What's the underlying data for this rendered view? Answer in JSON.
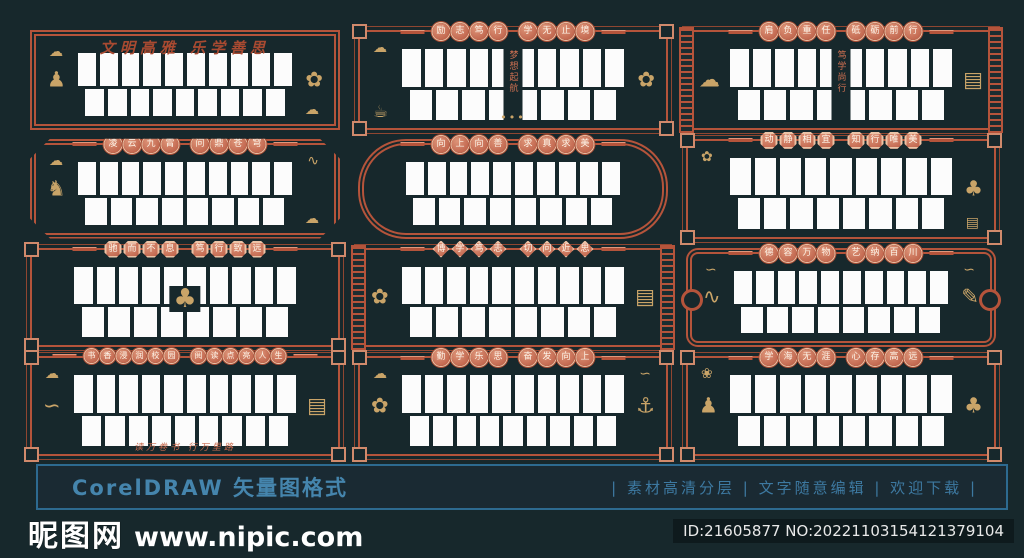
{
  "colors": {
    "background": "#17282c",
    "border_red": "#b5543b",
    "medallion_light": "#dd9478",
    "ornament_gold": "#c9a468",
    "bar_border_blue": "#2d6a90",
    "bar_text_blue": "#4585ad",
    "photo_white": "#fcfcfc"
  },
  "panels": [
    {
      "title": "文明高雅 乐学善思",
      "title_style": "calligraphy",
      "variant": "double",
      "photos_top": 10,
      "photos_bottom": 9,
      "ornaments": [
        {
          "icon": "cloud",
          "pos": "tl"
        },
        {
          "icon": "dancer",
          "pos": "l"
        },
        {
          "icon": "flower-vase",
          "pos": "r"
        },
        {
          "icon": "cloud",
          "pos": "br"
        }
      ]
    },
    {
      "title": "励志笃行 学无止境",
      "title_style": "circles",
      "variant": "corners",
      "photos_top": 10,
      "photos_bottom": 8,
      "center_text": "梦想起航",
      "ornaments": [
        {
          "icon": "cloud",
          "pos": "tl"
        },
        {
          "icon": "teapot",
          "pos": "bl"
        },
        {
          "icon": "flower-vase",
          "pos": "r"
        },
        {
          "icon": "water-drops",
          "pos": "cb"
        }
      ]
    },
    {
      "title": "肩负重任 砥砺前行",
      "title_style": "circles",
      "variant": "keys",
      "photos_top": 10,
      "photos_bottom": 8,
      "center_text": "笃学尚行",
      "ornaments": [
        {
          "icon": "cloud",
          "pos": "l"
        },
        {
          "icon": "scroll-stack",
          "pos": "r"
        }
      ]
    },
    {
      "title": "凌云九霄 问鼎苍穹",
      "title_style": "circles",
      "variant": "octagon",
      "photos_top": 10,
      "photos_bottom": 8,
      "ornaments": [
        {
          "icon": "cloud",
          "pos": "tl"
        },
        {
          "icon": "horse",
          "pos": "l"
        },
        {
          "icon": "fish",
          "pos": "tr"
        },
        {
          "icon": "cloud",
          "pos": "br"
        }
      ]
    },
    {
      "title": "向上向善 求真求美",
      "title_style": "circles",
      "variant": "round",
      "photos_top": 10,
      "photos_bottom": 8,
      "ornaments": []
    },
    {
      "title": "动静相宜 知行唯美",
      "title_style": "octagons",
      "variant": "corners",
      "photos_top": 9,
      "photos_bottom": 8,
      "ornaments": [
        {
          "icon": "flower-branch",
          "pos": "tl"
        },
        {
          "icon": "tree",
          "pos": "r"
        },
        {
          "icon": "book",
          "pos": "br"
        }
      ]
    },
    {
      "title": "驰而不息 笃行致远",
      "title_style": "octagons",
      "variant": "corners",
      "photos_top": 10,
      "photos_bottom": 8,
      "ornaments": [
        {
          "icon": "tree-reader",
          "pos": "c"
        }
      ]
    },
    {
      "title": "博学笃志 切问近思",
      "title_style": "diamonds",
      "variant": "keys",
      "photos_top": 10,
      "photos_bottom": 8,
      "ornaments": [
        {
          "icon": "flower-vase",
          "pos": "l"
        },
        {
          "icon": "scroll-stack",
          "pos": "r"
        }
      ]
    },
    {
      "title": "德容万物 艺纳百川",
      "title_style": "circles",
      "variant": "scroll",
      "photos_top": 10,
      "photos_bottom": 8,
      "ornaments": [
        {
          "icon": "bird",
          "pos": "tl"
        },
        {
          "icon": "fish",
          "pos": "l"
        },
        {
          "icon": "bird",
          "pos": "tr"
        },
        {
          "icon": "brush",
          "pos": "r"
        }
      ]
    },
    {
      "title": "书香浸润校园 阅读点亮人生",
      "title_style": "circles",
      "variant": "corners",
      "photos_top": 10,
      "photos_bottom": 9,
      "footer_text": "读万卷书 行万里路",
      "ornaments": [
        {
          "icon": "cloud",
          "pos": "tl"
        },
        {
          "icon": "bird",
          "pos": "l"
        },
        {
          "icon": "scroll-stack",
          "pos": "r"
        }
      ]
    },
    {
      "title": "勤学乐思 奋发向上",
      "title_style": "circles",
      "variant": "corners",
      "photos_top": 10,
      "photos_bottom": 9,
      "ornaments": [
        {
          "icon": "cloud",
          "pos": "tl"
        },
        {
          "icon": "lotus",
          "pos": "l"
        },
        {
          "icon": "bird",
          "pos": "tr"
        },
        {
          "icon": "boat",
          "pos": "r"
        }
      ]
    },
    {
      "title": "学海无涯 心存高远",
      "title_style": "circles",
      "variant": "corners",
      "photos_top": 9,
      "photos_bottom": 8,
      "ornaments": [
        {
          "icon": "sun",
          "pos": "tl"
        },
        {
          "icon": "reader",
          "pos": "l"
        },
        {
          "icon": "tree",
          "pos": "r"
        }
      ]
    }
  ],
  "footer_bar": {
    "left_label": "CorelDRAW 矢量图格式",
    "separator": "|",
    "items": [
      "素材高清分层",
      "文字随意编辑",
      "欢迎下载"
    ]
  },
  "watermark": {
    "site_name": "昵图网",
    "site_url": "www.nipic.com",
    "id_text": "ID:21605877 NO:20221103154121379104"
  },
  "icon_glyphs": {
    "cloud": "☁",
    "dancer": "♟",
    "flower-vase": "✿",
    "teapot": "☕",
    "water-drops": "•••",
    "scroll-stack": "▤",
    "horse": "♞",
    "fish": "∿",
    "flower-branch": "✿",
    "tree": "♣",
    "book": "▤",
    "tree-reader": "♣",
    "brush": "✎",
    "bird": "∽",
    "lotus": "✿",
    "boat": "⚓",
    "sun": "❀",
    "reader": "♟"
  }
}
